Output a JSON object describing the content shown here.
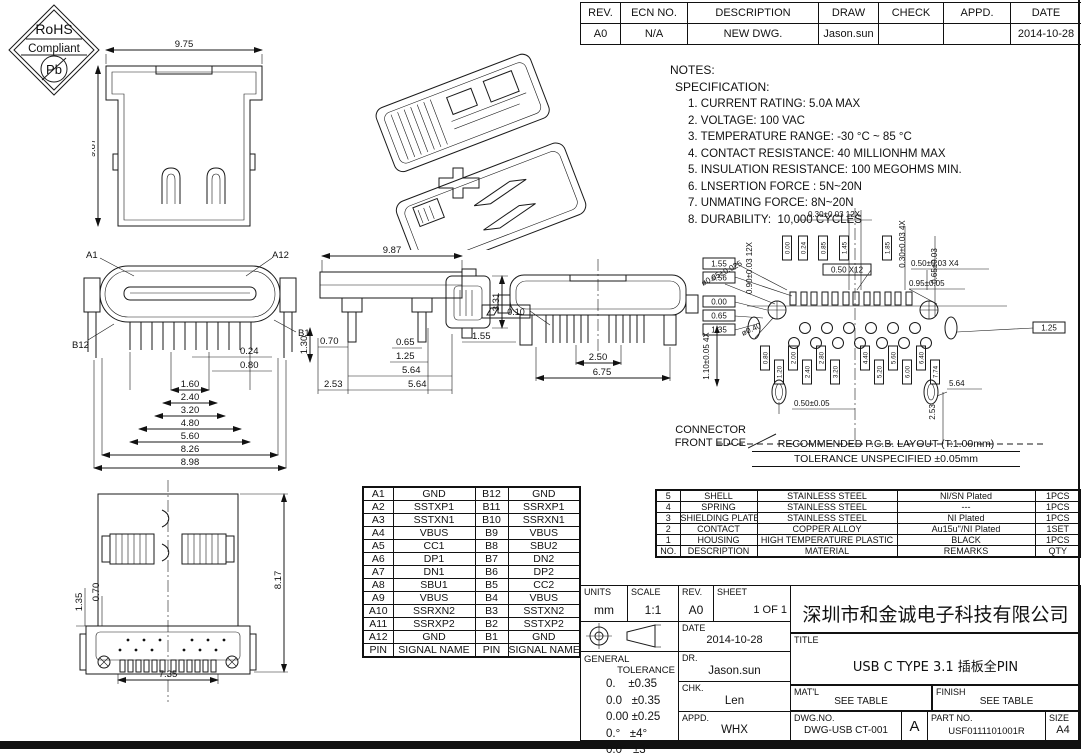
{
  "revision_table": {
    "rows": [
      [
        "REV.",
        "ECN NO.",
        "DESCRIPTION",
        "DRAW",
        "CHECK",
        "APPD.",
        "DATE"
      ],
      [
        "A0",
        "N/A",
        "NEW DWG.",
        "Jason.sun",
        "",
        "",
        "2014-10-28"
      ]
    ]
  },
  "rohs_badge": {
    "line1": "RoHS",
    "line2": "Compliant",
    "line3": "Pb"
  },
  "notes": {
    "title": "NOTES:",
    "subtitle": "SPECIFICATION:",
    "items": [
      "1. CURRENT RATING: 5.0A MAX",
      "2. VOLTAGE: 100 VAC",
      "3. TEMPERATURE RANGE: -30 °C ~ 85 °C",
      "4. CONTACT RESISTANCE: 40 MILLIONHM MAX",
      "5. INSULATION RESISTANCE: 100 MEGOHMS MIN.",
      "6. LNSERTION FORCE : 5N~20N",
      "7. UNMATING FORCE: 8N~20N",
      "8. DURABILITY:  10,000 CYCLES"
    ]
  },
  "views": {
    "top_view": {
      "dim_width": "9.75",
      "dim_height": "9.87"
    },
    "front_view": {
      "label_a1": "A1",
      "label_a12": "A12",
      "label_b12": "B12",
      "label_b1": "B1",
      "dim_024": "0.24",
      "dim_080": "0.80",
      "dim_130": "1.30",
      "stack": [
        "1.60",
        "2.40",
        "3.20",
        "4.80",
        "5.60",
        "8.26",
        "8.98"
      ]
    },
    "side_view": {
      "dim_top": "9.87",
      "dim_331": "3.31",
      "dim_155": "1.55",
      "dim_070": "0.70",
      "dim_065": "0.65",
      "dim_125": "1.25",
      "dim_564a": "5.64",
      "dim_564b": "5.64",
      "dim_253": "2.53"
    },
    "bottom_view": {
      "flatness": "0.10",
      "dim_250": "2.50",
      "dim_675": "6.75"
    },
    "rear_view": {
      "dim_817": "8.17",
      "dim_735": "7.35",
      "dim_135": "1.35",
      "dim_070": "0.70"
    }
  },
  "pcb_layout": {
    "caption_line1": "RECOMMENDED  P.C.B. LAYOUT (T:1.00mm)",
    "caption_line2": "TOLERANCE UNSPECIFIED ±0.05mm",
    "front_edge_line1": "CONNECTOR",
    "front_edge_line2": "FRONT EDCE",
    "ann_top": "0.30±0.03 12X",
    "ann_left_v": "0.90±0.03 12X",
    "ann_dia_065": "ø0.65±0.025",
    "ann_box_155": "1.55",
    "ann_box_056": "0.56",
    "ann_box_050x12": "0.50 X12",
    "ann_050x4": "0.50±0.03 X4",
    "ann_095": "0.95±0.05",
    "ann_right_4x": "0.30±0.03 4X",
    "ann_right_065": "0.65±0.03",
    "ann_box_000": "0.00",
    "ann_box_065": "0.65",
    "ann_box_135": "1.35",
    "ann_dia_040": "ø0.40",
    "ann_110": "1.10±0.05 4X",
    "ann_050": "0.50±0.05",
    "ann_564": "5.64",
    "ann_253": "2.53",
    "ann_box_125": "1.25",
    "pad_dims_top": [
      "0.00",
      "0.24",
      "0.85",
      "1.45",
      "1.85"
    ],
    "pad_dims_bottom": [
      "0.80",
      "1.20",
      "2.00",
      "2.40",
      "2.80",
      "3.20",
      "4.40",
      "5.20",
      "5.60",
      "6.00",
      "6.40",
      "7.74"
    ]
  },
  "pin_table": {
    "rows": [
      [
        "A1",
        "GND",
        "B12",
        "GND"
      ],
      [
        "A2",
        "SSTXP1",
        "B11",
        "SSRXP1"
      ],
      [
        "A3",
        "SSTXN1",
        "B10",
        "SSRXN1"
      ],
      [
        "A4",
        "VBUS",
        "B9",
        "VBUS"
      ],
      [
        "A5",
        "CC1",
        "B8",
        "SBU2"
      ],
      [
        "A6",
        "DP1",
        "B7",
        "DN2"
      ],
      [
        "A7",
        "DN1",
        "B6",
        "DP2"
      ],
      [
        "A8",
        "SBU1",
        "B5",
        "CC2"
      ],
      [
        "A9",
        "VBUS",
        "B4",
        "VBUS"
      ],
      [
        "A10",
        "SSRXN2",
        "B3",
        "SSTXN2"
      ],
      [
        "A11",
        "SSRXP2",
        "B2",
        "SSTXP2"
      ],
      [
        "A12",
        "GND",
        "B1",
        "GND"
      ],
      [
        "PIN",
        "SIGNAL NAME",
        "PIN",
        "SIGNAL NAME"
      ]
    ]
  },
  "bom_table": {
    "rows": [
      [
        "5",
        "SHELL",
        "STAINLESS STEEL",
        "NI/SN  Plated",
        "1PCS"
      ],
      [
        "4",
        "SPRING",
        "STAINLESS STEEL",
        "---",
        "1PCS"
      ],
      [
        "3",
        "SHIELDING PLATE",
        "STAINLESS STEEL",
        "NI  Plated",
        "1PCS"
      ],
      [
        "2",
        "CONTACT",
        "COPPER ALLOY",
        "Au15u\"/NI Plated",
        "1SET"
      ],
      [
        "1",
        "HOUSING",
        "HIGH TEMPERATURE PLASTIC",
        "BLACK",
        "1PCS"
      ],
      [
        "NO.",
        "DESCRIPTION",
        "MATERIAL",
        "REMARKS",
        "QTY"
      ]
    ]
  },
  "title_block": {
    "units_label": "UNITS",
    "units_value": "mm",
    "scale_label": "SCALE",
    "scale_value": "1:1",
    "rev_label": "REV.",
    "rev_value": "A0",
    "sheet_label": "SHEET",
    "sheet_value": "1 OF 1",
    "date_label": "DATE",
    "date_value": "2014-10-28",
    "dr_label": "DR.",
    "dr_value": "Jason.sun",
    "chk_label": "CHK.",
    "chk_value": "Len",
    "appd_label": "APPD.",
    "appd_value": "WHX",
    "general_tolerance_line1": "GENERAL",
    "general_tolerance_line2": "TOLERANCE",
    "tolerances": [
      "0.    ±0.35",
      "0.0   ±0.35",
      "0.00 ±0.25",
      "0.°   ±4°",
      "0.0°  ±3°"
    ],
    "company": "深圳市和金诚电子科技有限公司",
    "title_label": "TITLE",
    "title_value": "USB C TYPE 3.1 插板全PIN",
    "matl_label": "MAT'L",
    "matl_value": "SEE TABLE",
    "finish_label": "FINISH",
    "finish_value": "SEE TABLE",
    "dwg_label": "DWG.NO.",
    "dwg_value": "DWG-USB CT-001",
    "frame_rev": "A",
    "part_label": "PART NO.",
    "part_value": "USF0111101001R",
    "size_label": "SIZE",
    "size_value": "A4"
  }
}
